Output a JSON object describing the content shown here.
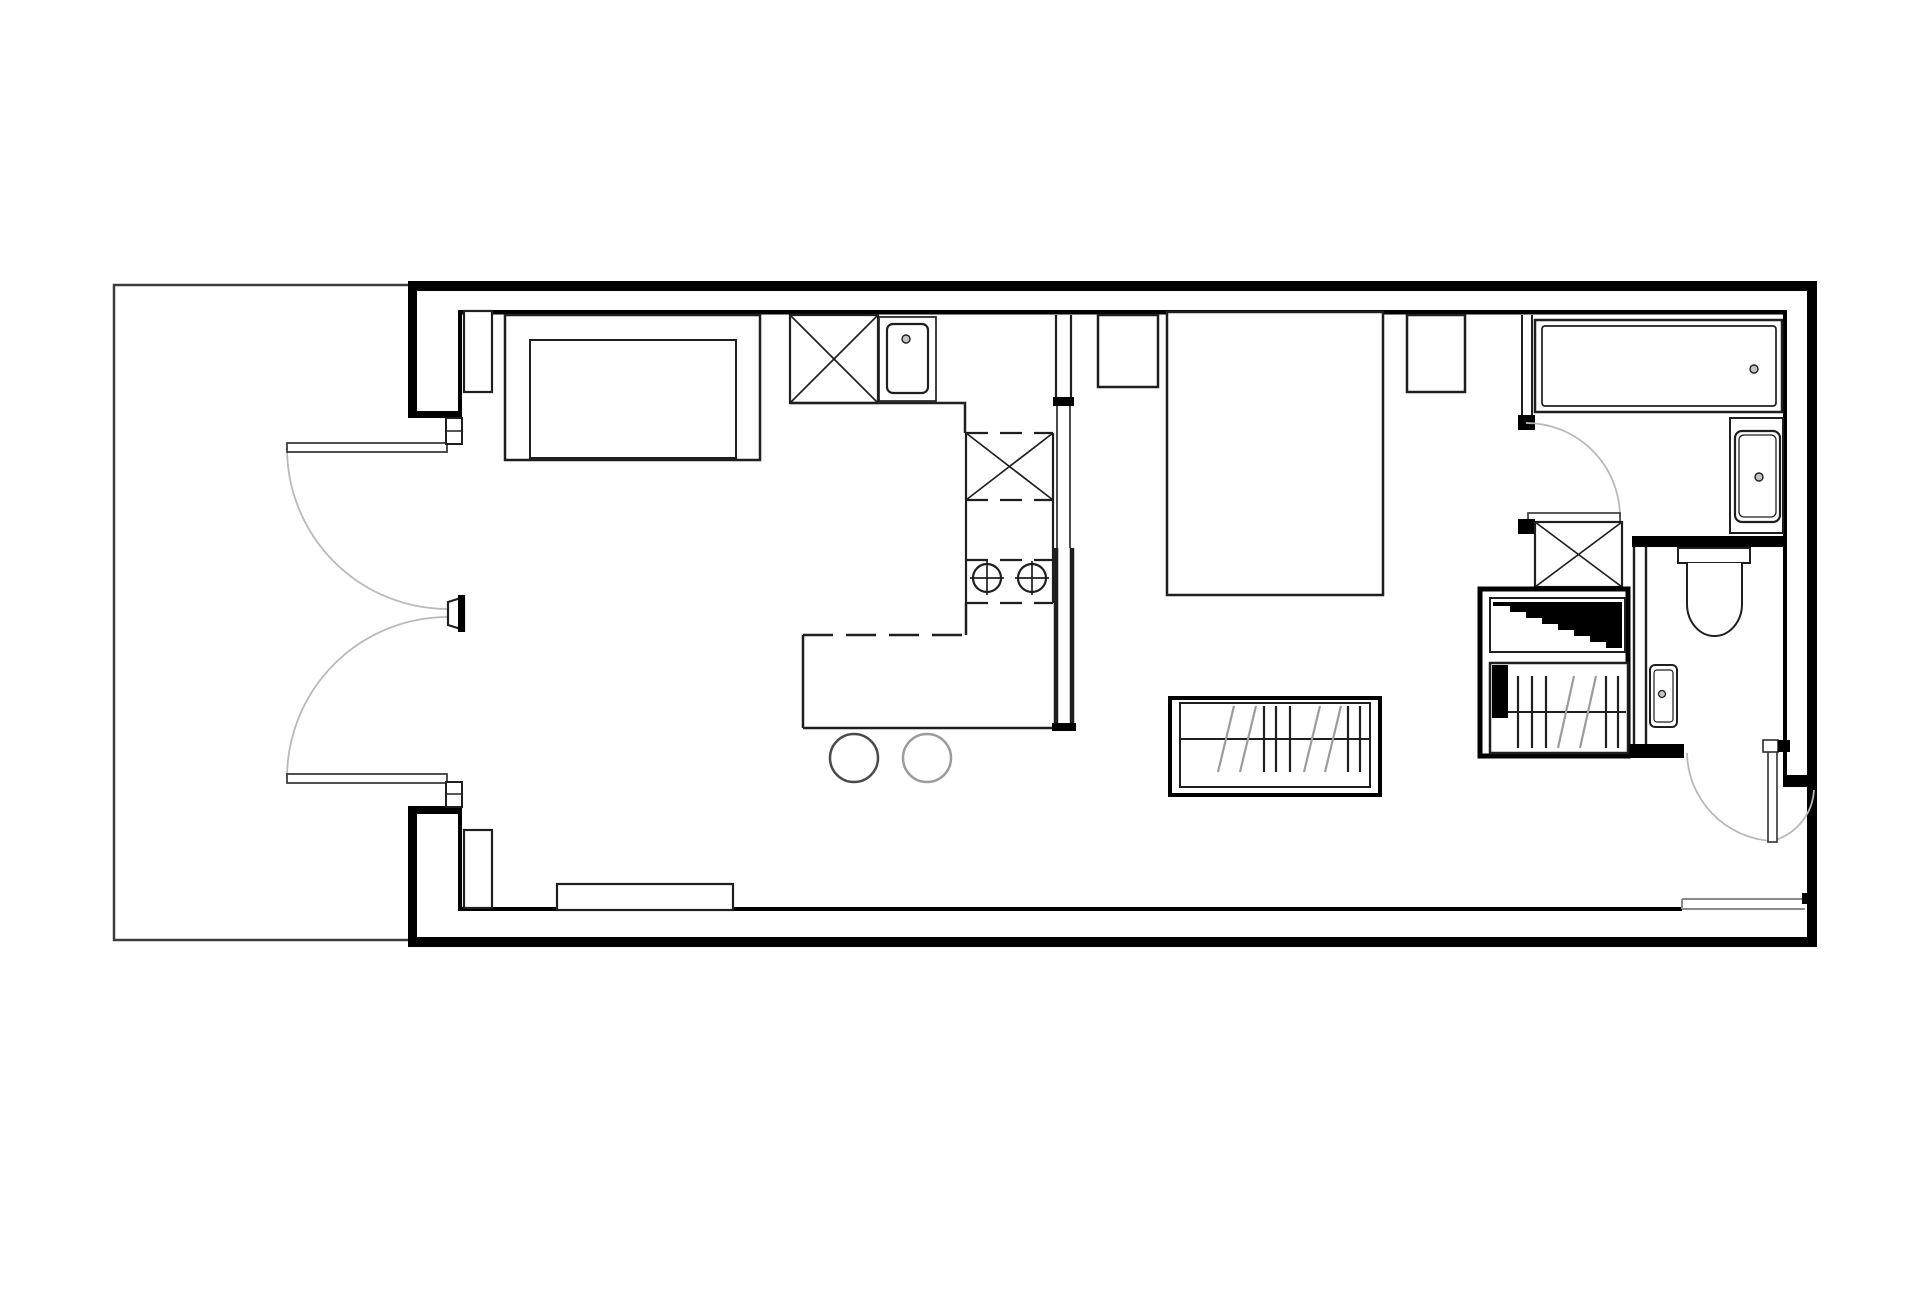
{
  "meta": {
    "title": "Black and white architectural floor plan of a one-bedroom apartment with terrace",
    "drawing_type": "floor-plan",
    "canvas": {
      "width": 1920,
      "height": 1309,
      "background": "#ffffff"
    }
  },
  "colors": {
    "wall": "#000000",
    "ink": "#1f1f1f",
    "leaf": "#3d3d3d",
    "arc": "#b9b9b9",
    "faded": "#9b9b9b",
    "sill": "#8a8a8a",
    "boundary": "#3c3c3c"
  },
  "plan": {
    "rooms": [
      {
        "name": "terrace"
      },
      {
        "name": "living-room"
      },
      {
        "name": "kitchen"
      },
      {
        "name": "bedroom"
      },
      {
        "name": "bathroom"
      },
      {
        "name": "wc"
      },
      {
        "name": "entry-hall"
      }
    ],
    "fixtures": [
      {
        "name": "double-entry-doors-to-terrace"
      },
      {
        "name": "sofa"
      },
      {
        "name": "wall-pier-top"
      },
      {
        "name": "wall-pier-bottom"
      },
      {
        "name": "tall-cabinet-x"
      },
      {
        "name": "kitchen-sink"
      },
      {
        "name": "kitchen-counter"
      },
      {
        "name": "mid-cabinet-x"
      },
      {
        "name": "cooktop-two-burners"
      },
      {
        "name": "kitchen-island"
      },
      {
        "name": "bar-stool-left"
      },
      {
        "name": "bar-stool-right"
      },
      {
        "name": "bed"
      },
      {
        "name": "nightstand-left"
      },
      {
        "name": "nightstand-right"
      },
      {
        "name": "bedroom-radiator"
      },
      {
        "name": "bathroom-door"
      },
      {
        "name": "bathtub"
      },
      {
        "name": "washbasin-vanity"
      },
      {
        "name": "duct-shaft-x"
      },
      {
        "name": "stair-void-triangle"
      },
      {
        "name": "hall-radiator"
      },
      {
        "name": "toilet"
      },
      {
        "name": "wc-hand-basin"
      },
      {
        "name": "wc-door"
      },
      {
        "name": "entrance-threshold"
      },
      {
        "name": "bench-seat"
      }
    ]
  }
}
